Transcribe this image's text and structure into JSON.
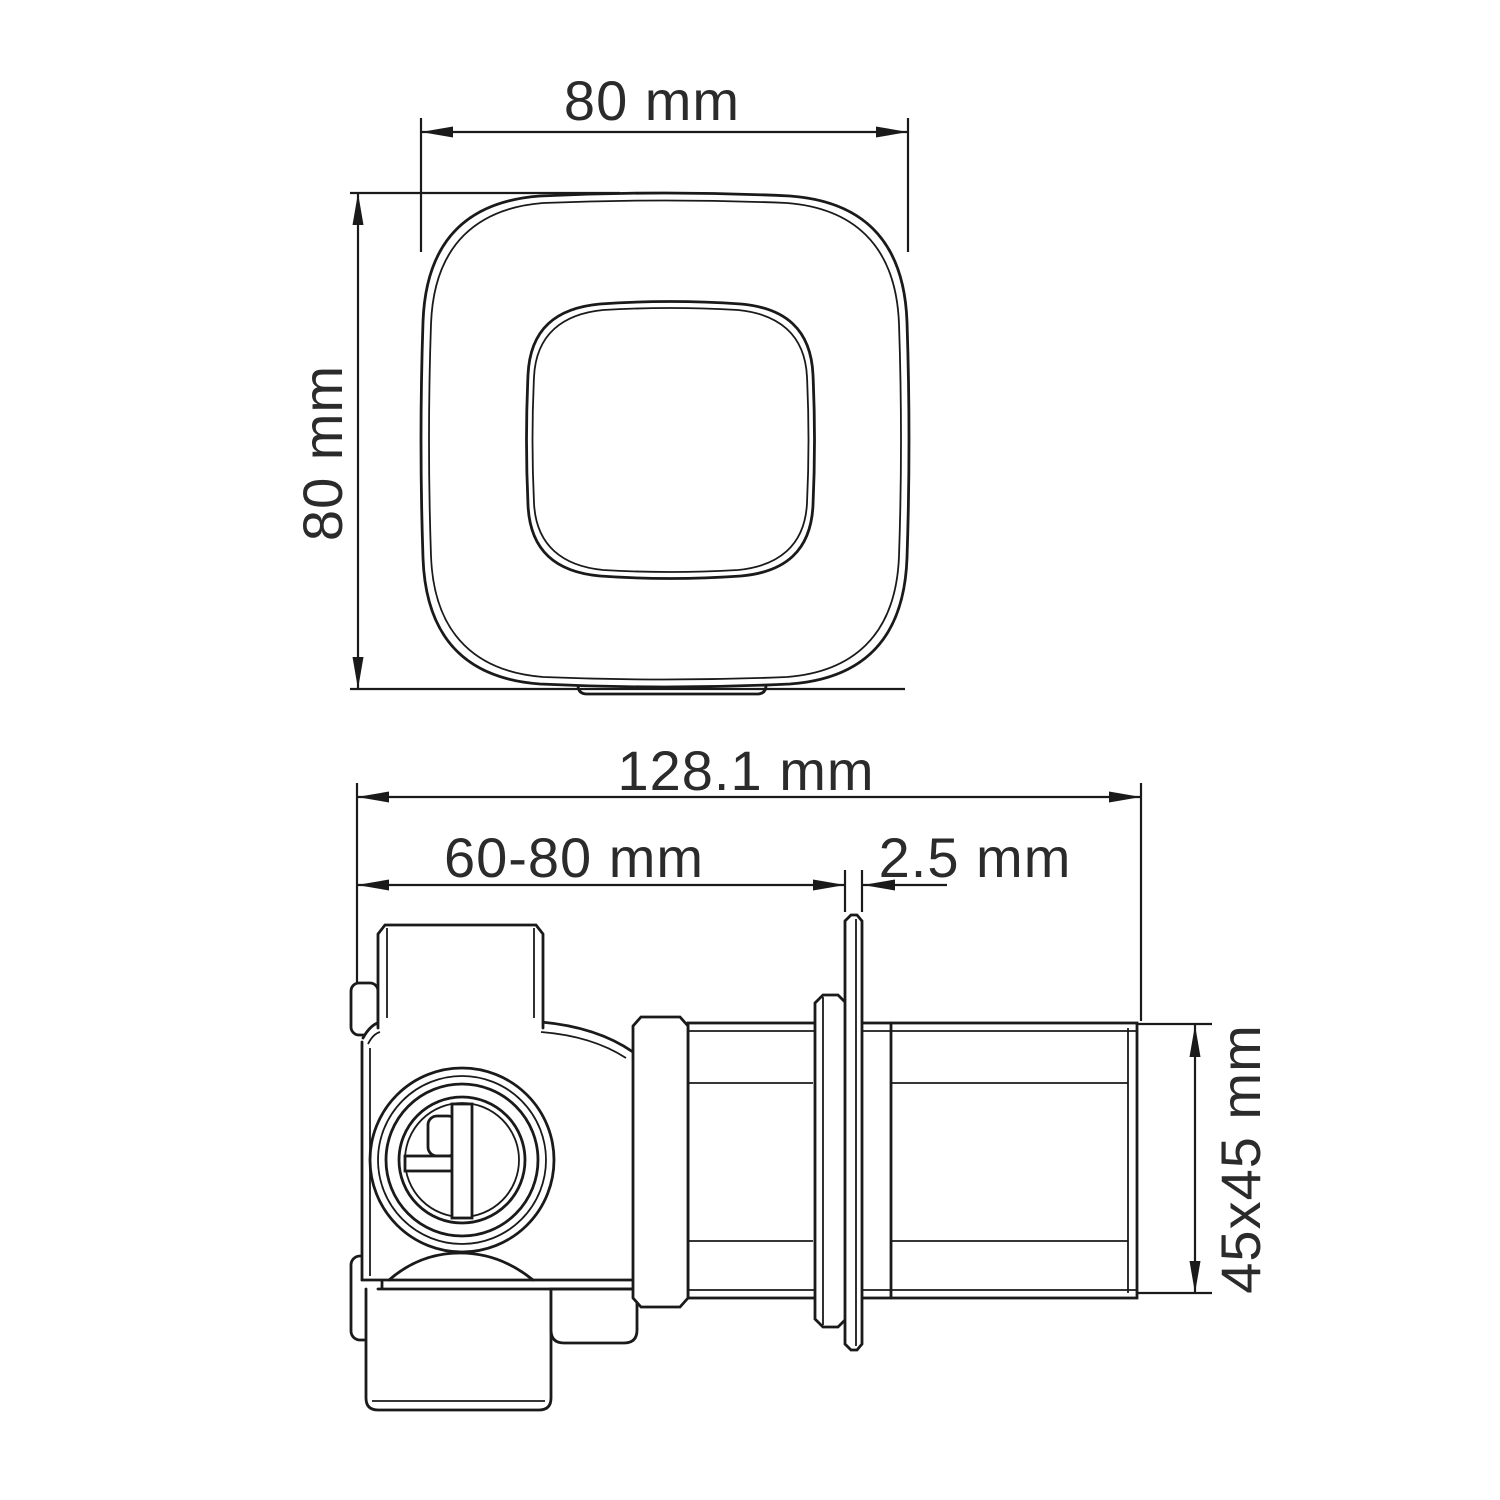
{
  "drawing": {
    "background_color": "#ffffff",
    "line_color": "#1a1a1a",
    "text_color": "#2b2b2b"
  },
  "top_view": {
    "width_dim": "80 mm",
    "height_dim": "80 mm"
  },
  "side_view": {
    "overall_length_dim": "128.1 mm",
    "mounting_depth_dim": "60-80 mm",
    "plate_thickness_dim": "2.5 mm",
    "square_section_dim": "45x45 mm"
  }
}
